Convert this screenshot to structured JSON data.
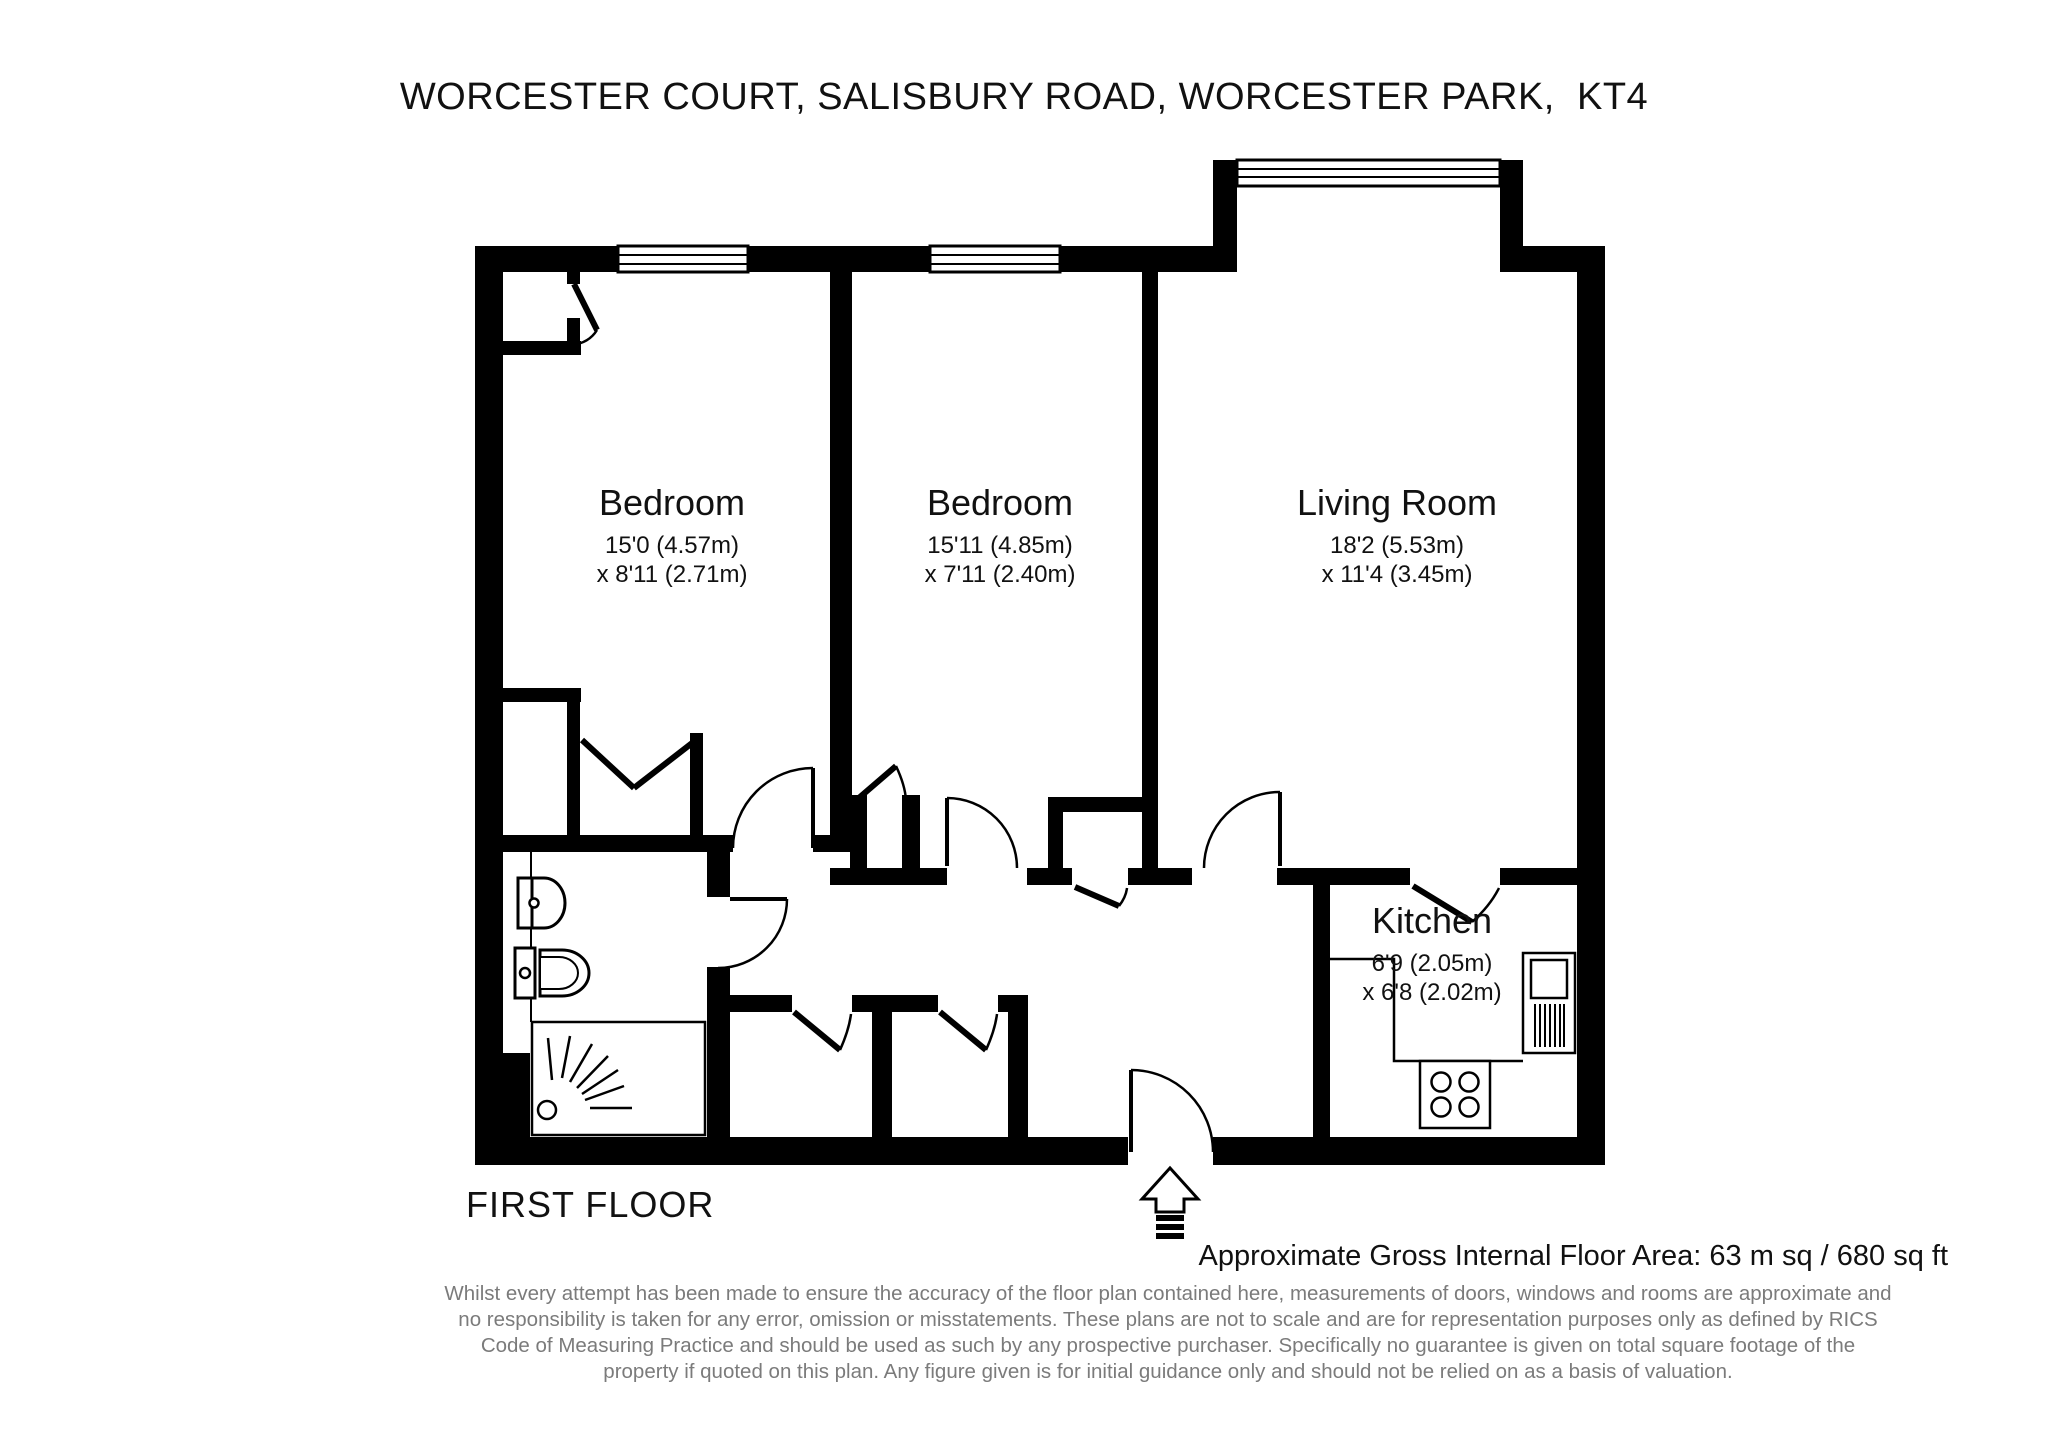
{
  "title": "WORCESTER COURT, SALISBURY ROAD, WORCESTER PARK,  KT4",
  "floor": {
    "label": "FIRST FLOOR"
  },
  "area_summary": "Approximate Gross Internal Floor Area: 63 m sq / 680 sq ft",
  "rooms": {
    "bedroom1": {
      "name": "Bedroom",
      "dim1": "15'0 (4.57m)",
      "dim2": "x 8'11 (2.71m)"
    },
    "bedroom2": {
      "name": "Bedroom",
      "dim1": "15'11 (4.85m)",
      "dim2": "x 7'11 (2.40m)"
    },
    "living": {
      "name": "Living Room",
      "dim1": "18'2 (5.53m)",
      "dim2": "x 11'4 (3.45m)"
    },
    "kitchen": {
      "name": "Kitchen",
      "dim1": "6'9 (2.05m)",
      "dim2": "x 6'8 (2.02m)"
    }
  },
  "fixtures": {
    "bathroom": [
      "wash-basin",
      "toilet",
      "shower"
    ],
    "kitchen": [
      "hob",
      "fridge-freezer",
      "worktop"
    ],
    "entrance": "entrance-arrow"
  },
  "disclaimer": {
    "lines": [
      "Whilst every attempt has been made to ensure the accuracy of the floor plan contained here, measurements of doors, windows and rooms are approximate and",
      "no responsibility is taken for any error, omission or misstatements. These plans are not to scale and are for representation purposes only as defined by RICS",
      "Code of Measuring Practice and should be used as such by any prospective purchaser. Specifically no guarantee is given on total square footage of the",
      "property if quoted on this plan. Any figure given is for initial guidance only and should not be relied on as a basis of valuation."
    ]
  },
  "colors": {
    "wall": "#000000",
    "line": "#000000",
    "disclaimer_text": "#7b7b7b",
    "background": "#ffffff"
  }
}
